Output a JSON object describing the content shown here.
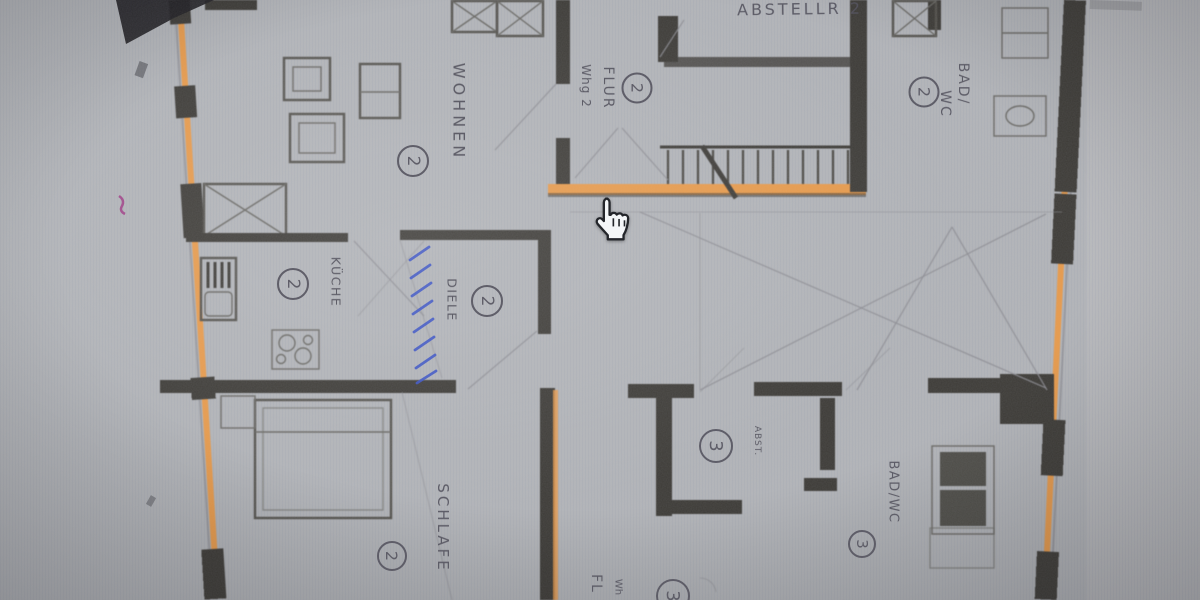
{
  "colors": {
    "paper": "#b3b5b9",
    "wall": "#3e3c38",
    "highlight": "#e89b4c",
    "pen": "#3a53c6",
    "pencil": "#8d8d94",
    "ink": "#565560"
  },
  "cursor": {
    "shape": "hand-pointer"
  },
  "floorplan": {
    "storage2": {
      "name": "ABSTELLR 2"
    },
    "hall2": {
      "wing": "Whg 2",
      "name": "FLUR",
      "number": "2"
    },
    "bath2": {
      "name_line1": "BAD/",
      "name_line2": "WC",
      "number": "2"
    },
    "living2": {
      "name": "WOHNEN",
      "number": "2"
    },
    "kitchen2": {
      "name": "KÜCHE",
      "number": "2"
    },
    "hallway2": {
      "name": "DIELE",
      "number": "2"
    },
    "bedroom2": {
      "name": "SCHLAFE",
      "number": "2"
    },
    "storage3": {
      "name": "ABST.",
      "number": "3"
    },
    "bath3": {
      "name": "BAD/WC",
      "number": "3"
    },
    "hall3": {
      "name": "FL",
      "wing": "Wh",
      "number": "3"
    }
  }
}
